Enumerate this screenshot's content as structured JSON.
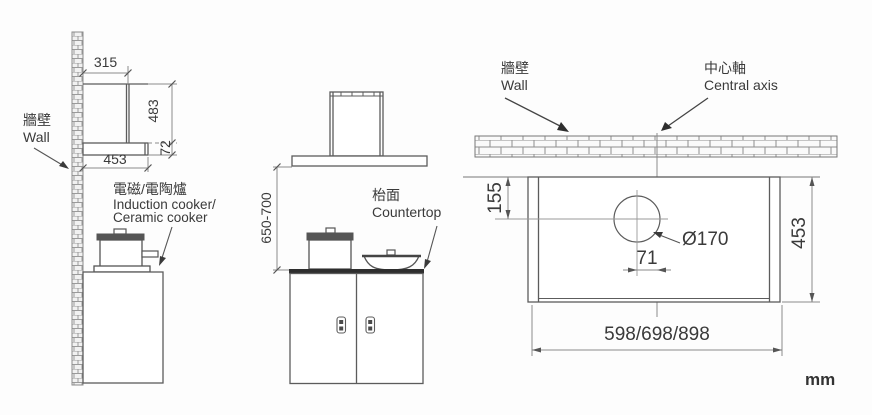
{
  "title": "Cooker hood installation dimension diagram",
  "unit": "mm",
  "colors": {
    "line": "#5c5c5c",
    "dimension_line": "#8a8a8a",
    "text": "#3a3a3a",
    "dark_fill": "#4a4a4a"
  },
  "labels": {
    "side_wall_zh": "牆壁",
    "side_wall_en": "Wall",
    "cooker_zh": "電磁/電陶爐",
    "cooker_en1": "Induction cooker/",
    "cooker_en2": "Ceramic cooker",
    "countertop_zh": "枱面",
    "countertop_en": "Countertop",
    "top_wall_zh": "牆壁",
    "top_wall_en": "Wall",
    "axis_zh": "中心軸",
    "axis_en": "Central axis"
  },
  "dims": {
    "side_top_depth": "315",
    "side_height": "483",
    "side_plate_height": "72",
    "side_depth": "453",
    "front_clearance": "650-700",
    "top_hole_offset_y": "155",
    "top_hole_dia": "Ø170",
    "top_hole_offset_x": "71",
    "top_depth": "453",
    "top_width": "598/698/898"
  }
}
